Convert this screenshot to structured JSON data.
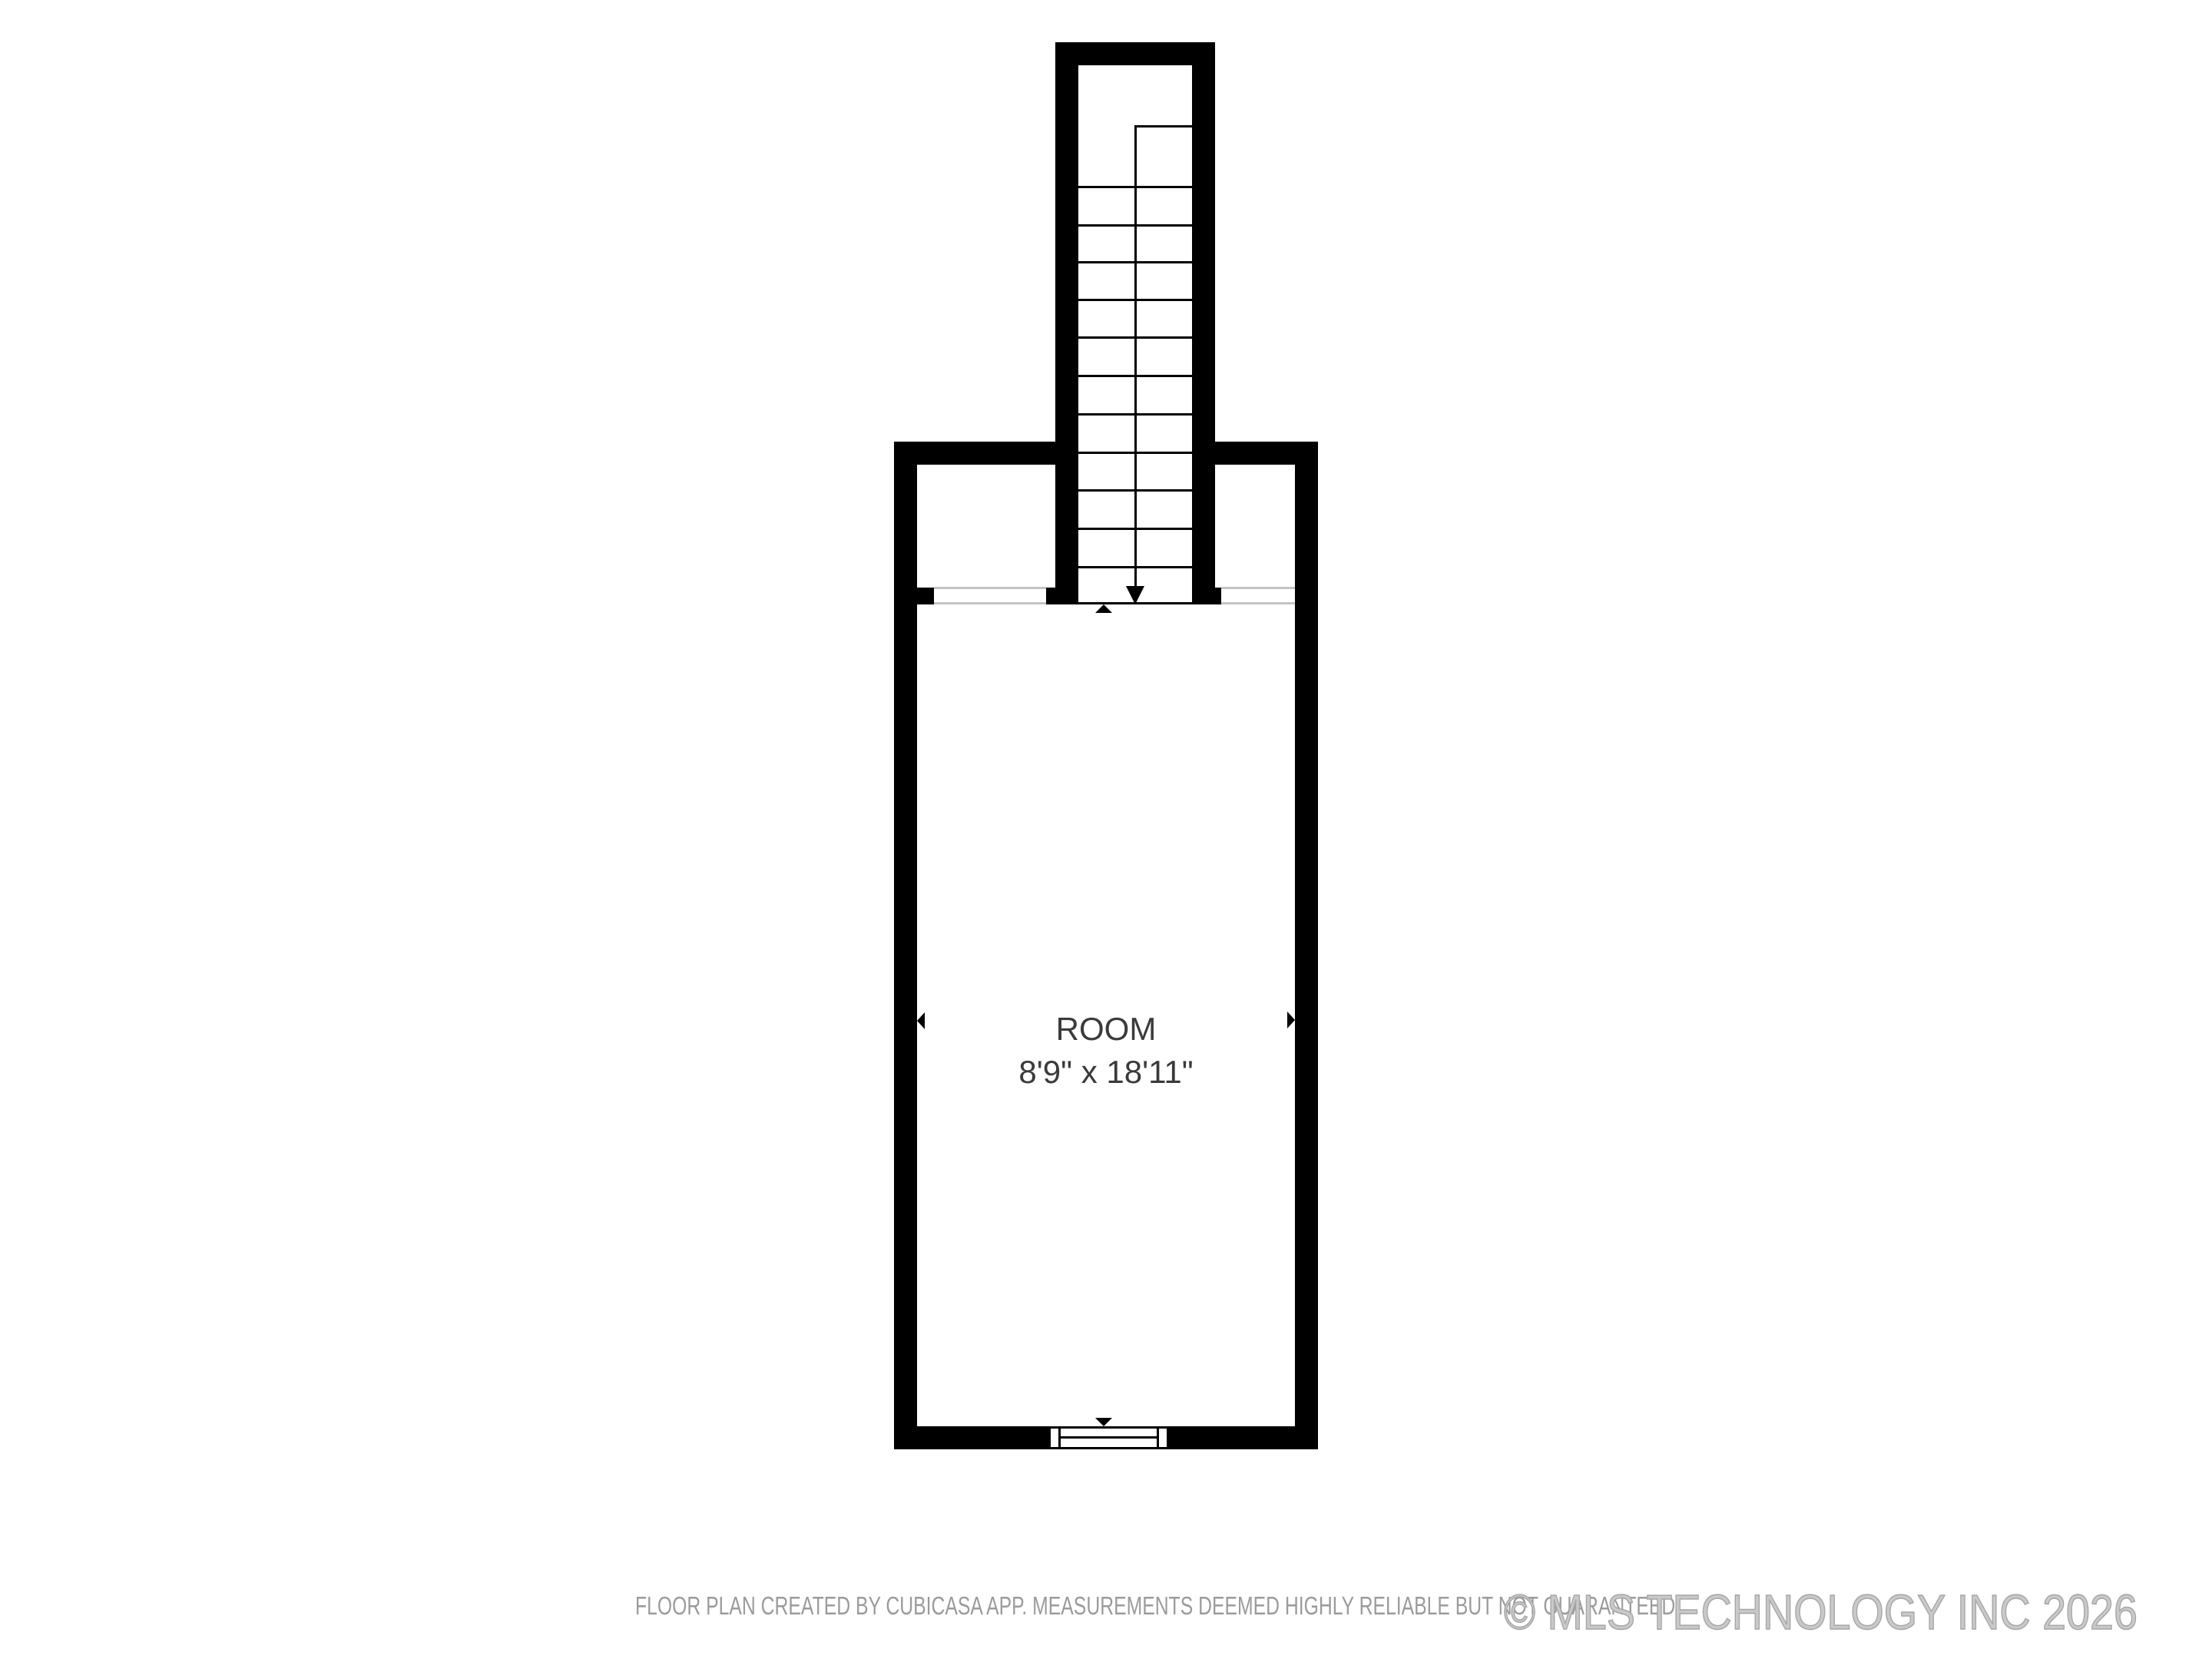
{
  "plan": {
    "room": {
      "name": "ROOM",
      "dimensions": "8'9\" x 18'11\""
    },
    "stairs": {
      "tread_count": 11,
      "direction_symbol": "down-arrow"
    },
    "symbols": [
      "stair-direction-arrow",
      "measure-arrow-up",
      "measure-arrow-down",
      "measure-arrow-left",
      "measure-arrow-right",
      "window-symbol"
    ],
    "colors": {
      "wall": "#000000",
      "room_label": "#3a3a3a",
      "opening_line": "#c4c4c4",
      "disclaimer_text": "#9b9b9b",
      "watermark_text": "#b5b5b5",
      "background": "#ffffff"
    }
  },
  "footer": {
    "disclaimer": "FLOOR PLAN CREATED BY CUBICASA APP. MEASUREMENTS DEEMED HIGHLY RELIABLE BUT NOT GUARANTEED.",
    "watermark": "© MLS TECHNOLOGY INC 2026"
  }
}
